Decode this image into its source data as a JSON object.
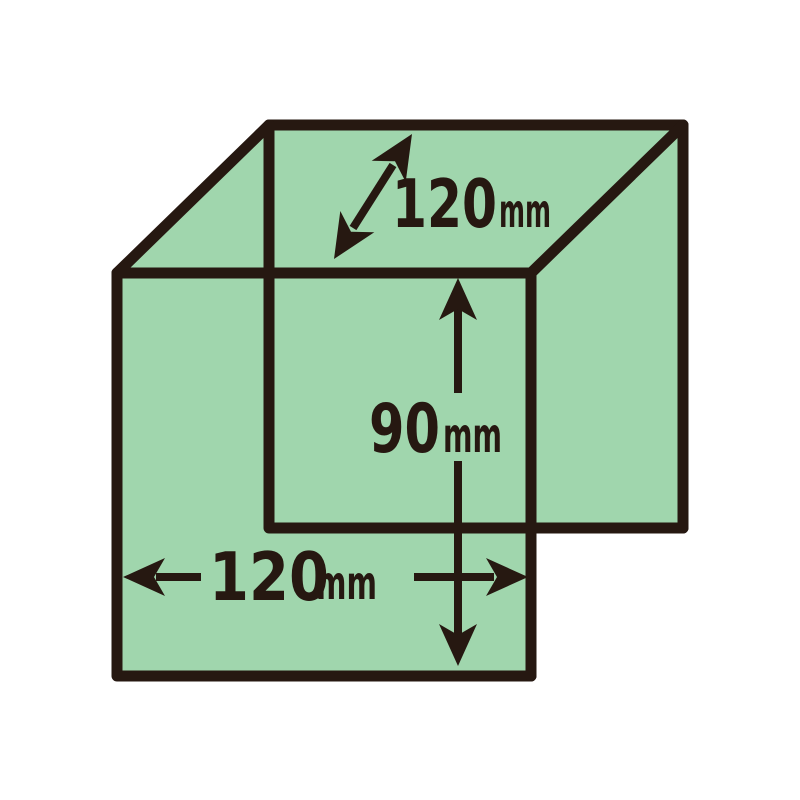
{
  "figure": {
    "type": "box-dimension-diagram",
    "description": "Rectangular box drawn in oblique projection with three dimension arrows",
    "background_color": "#ffffff",
    "fill_color": "#a0d6ad",
    "line_color": "#261811",
    "dimensions": {
      "depth": {
        "value": "120",
        "unit": "mm"
      },
      "height": {
        "value": "90",
        "unit": "mm"
      },
      "width": {
        "value": "120",
        "unit": "mm"
      }
    }
  }
}
